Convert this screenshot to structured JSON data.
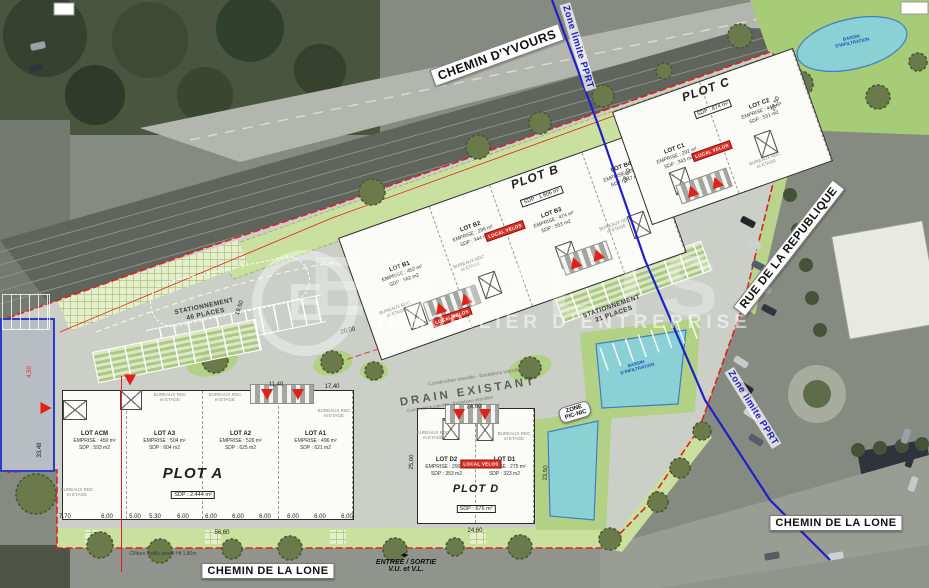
{
  "streets": {
    "yvours": "CHEMIN D'YVOURS",
    "republique": "RUE DE LA REPUBLIQUE",
    "lone_bottom": "CHEMIN DE LA LONE",
    "lone_right": "CHEMIN DE LA LONE"
  },
  "pprt_label": "Zone limite PPRT",
  "watermark": {
    "brand": "EVOLIS",
    "tagline": "IMMOBILIER D'ENTREPRISE"
  },
  "plots": {
    "a": {
      "name": "PLOT A",
      "sdp": "SDP : 2.444 m²",
      "lots": [
        {
          "name": "LOT ACM",
          "emprise": "EMPRISE : 450 m²",
          "sdp": "SDP : 593 m2"
        },
        {
          "name": "LOT A3",
          "emprise": "EMPRISE : 504 m²",
          "sdp": "SDP : 604 m2"
        },
        {
          "name": "LOT A2",
          "emprise": "EMPRISE : 526 m²",
          "sdp": "SDP : 625 m2"
        },
        {
          "name": "LOT A1",
          "emprise": "EMPRISE : 496 m²",
          "sdp": "SDP : 621 m2"
        }
      ]
    },
    "b": {
      "name": "PLOT B",
      "sdp": "SDP : 1.806 m²",
      "lots": [
        {
          "name": "LOT B1",
          "emprise": "EMPRISE : 452 m²",
          "sdp": "SDP : 562 m2"
        },
        {
          "name": "LOT B2",
          "emprise": "EMPRISE : 296 m²",
          "sdp": "SDP : 344 m2"
        },
        {
          "name": "LOT B3",
          "emprise": "EMPRISE : 474 m²",
          "sdp": "SDP : 553 m2"
        },
        {
          "name": "LOT B4",
          "emprise": "EMPRISE : 296 m²",
          "sdp": "SDP : 347 m2"
        }
      ]
    },
    "c": {
      "name": "PLOT C",
      "sdp": "SDP : 874 m²",
      "lots": [
        {
          "name": "LOT C1",
          "emprise": "EMPRISE : 292 m²",
          "sdp": "SDP : 343 m2"
        },
        {
          "name": "LOT C2",
          "emprise": "EMPRISE : 447 m²",
          "sdp": "SDP : 531 m2"
        }
      ]
    },
    "d": {
      "name": "PLOT D",
      "sdp": "SDP : 676 m²",
      "lots": [
        {
          "name": "LOT D2",
          "emprise": "EMPRISE : 290 m²",
          "sdp": "SDP : 353 m2"
        },
        {
          "name": "LOT D1",
          "emprise": "EMPRISE : 275 m²",
          "sdp": "SDP : 323 m2"
        }
      ]
    }
  },
  "parking": {
    "left": "STATIONNEMENT\n46 PLACES",
    "right": "STATIONNEMENT\n21 PLACES"
  },
  "site_labels": {
    "drain": "DRAIN EXISTANT",
    "picnic": "ZONE\nPIC-NIC",
    "entree": "ENTREE / SORTIE\nV.U. et V.L.",
    "entree_arrows": "◂▸",
    "cloture": "Clôture treillis soudé Ht 1,80m",
    "construction_note": "Construction interdite - fondations interdites",
    "bassin": "BASSIN\nD'INFILTRATION",
    "red_tag": "LOCAL VELOS",
    "bureaux_note": "BUREAUX RDC\net ETAGE"
  },
  "dimensions": {
    "bottom_row": [
      "7.70",
      "6.00",
      "5.00",
      "5.30",
      "6.00",
      "6.00",
      "6.00",
      "6.00",
      "6.00",
      "6.00",
      "6.00"
    ],
    "others": [
      "56,60",
      "33,48",
      "24,60",
      "24,60",
      "23,50",
      "25,00",
      "11,40",
      "17,40",
      "19,50",
      "20,00",
      "28,60",
      "28,50",
      "4,50"
    ]
  },
  "colors": {
    "boundary": "#e02020",
    "pprt_line": "#2020c8",
    "water": "#8bd0d4",
    "lawn": "#a6cc78",
    "plan_green": "#c9e09e",
    "accent_red": "#d9342a"
  }
}
